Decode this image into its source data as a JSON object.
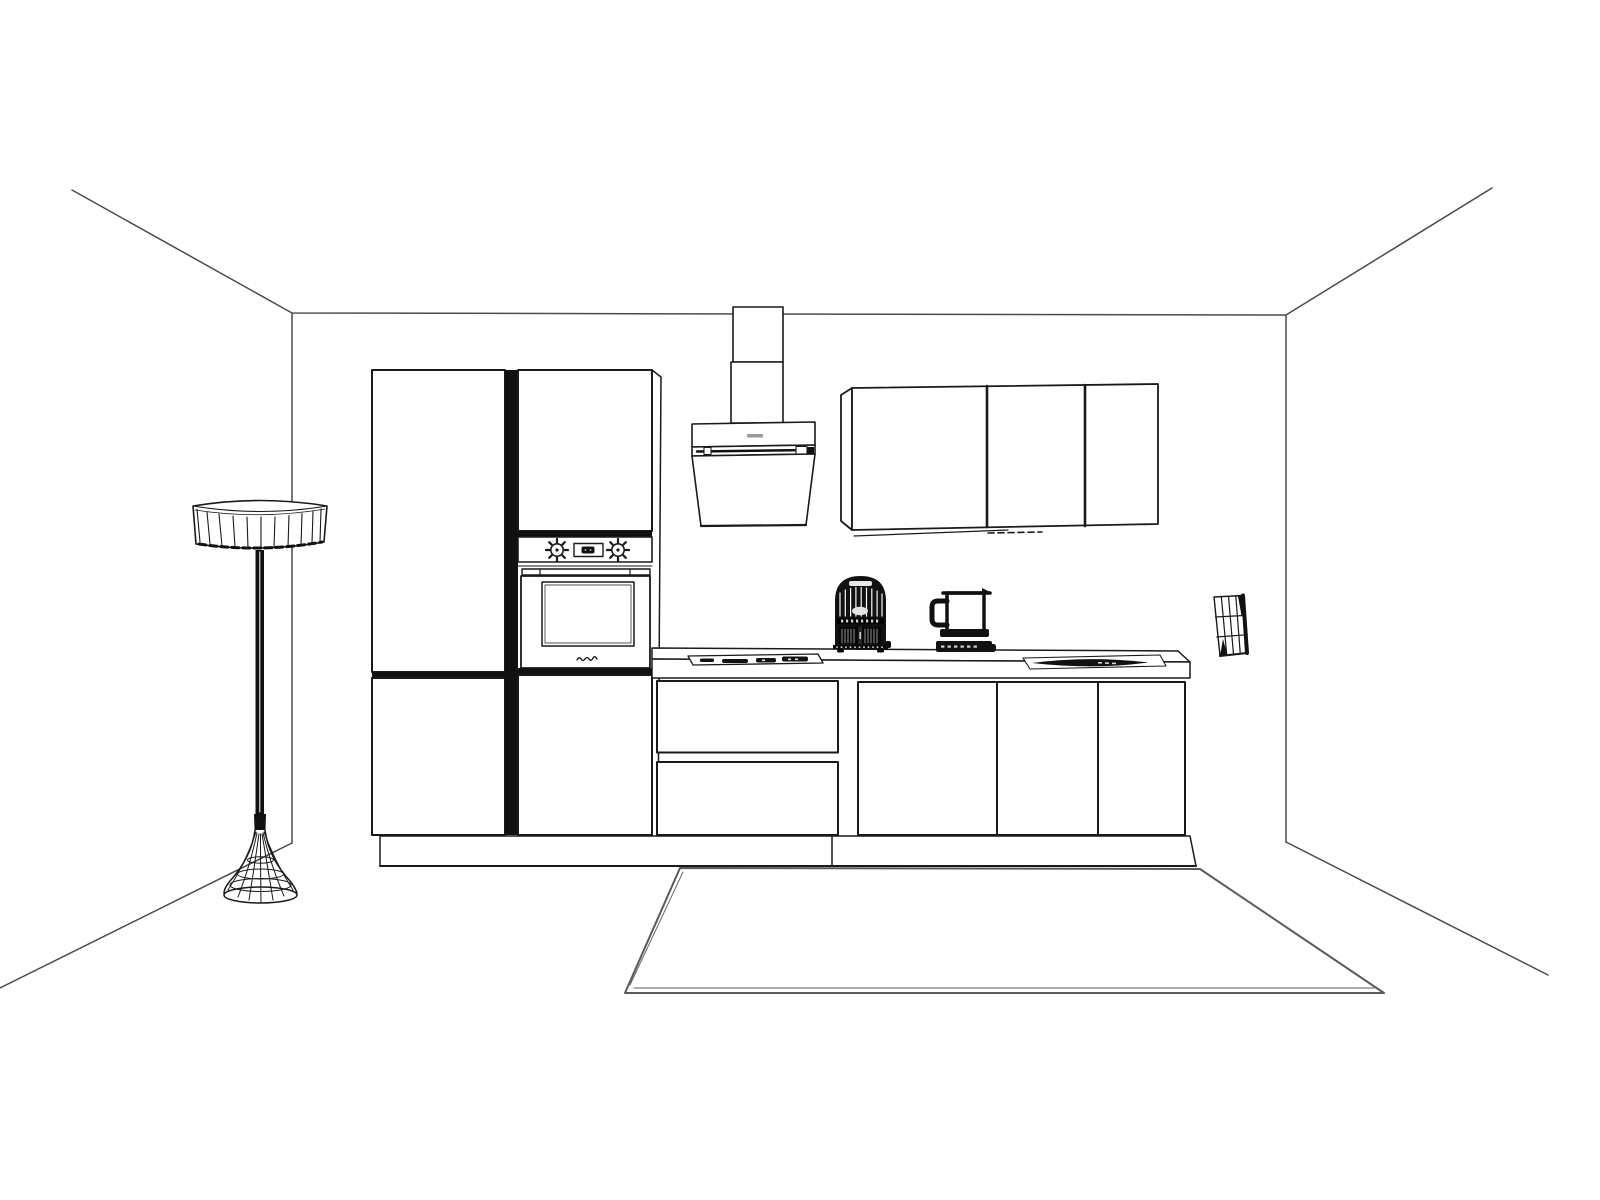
{
  "scene": {
    "kind": "single-point-perspective line drawing of a kitchen",
    "colors": {
      "background": "#ffffff",
      "ink": "#1a1a1a",
      "room_line": "#4a4a4a",
      "dark": "#111111",
      "brand_smudge": "#9a9a9a",
      "rug_line": "#5a5a5a"
    },
    "objects": [
      {
        "id": "room-shell",
        "label": "room ceiling, wall corners and floor edges"
      },
      {
        "id": "floor-lamp",
        "label": "wireframe floor lamp with ribbed drum shade and trumpet base"
      },
      {
        "id": "tall-cabinet-left",
        "label": "tall two-door cabinet"
      },
      {
        "id": "tall-cabinet-right",
        "label": "tall oven housing cabinet"
      },
      {
        "id": "built-in-oven",
        "label": "built-in oven with two knobs, display, handle and window"
      },
      {
        "id": "range-hood",
        "label": "angled chimney range hood with duct"
      },
      {
        "id": "wall-cabinets",
        "label": "three-door wall cabinet run with dashed under-cabinet line"
      },
      {
        "id": "countertop",
        "label": "worktop slab"
      },
      {
        "id": "drawer-unit",
        "label": "base unit with two drawers"
      },
      {
        "id": "base-cabinets",
        "label": "three-door base cabinet run"
      },
      {
        "id": "plinth",
        "label": "toe-kick plinth"
      },
      {
        "id": "gas-hob",
        "label": "flat hob with dark burner marks"
      },
      {
        "id": "cooktop-right",
        "label": "dark built-in cooktop"
      },
      {
        "id": "air-fryer",
        "label": "dark ribbed countertop appliance"
      },
      {
        "id": "blender",
        "label": "dark blender silhouette"
      },
      {
        "id": "wall-sconce",
        "label": "caged trapezoid wall light"
      },
      {
        "id": "rug",
        "label": "large floor rug in perspective"
      }
    ]
  }
}
